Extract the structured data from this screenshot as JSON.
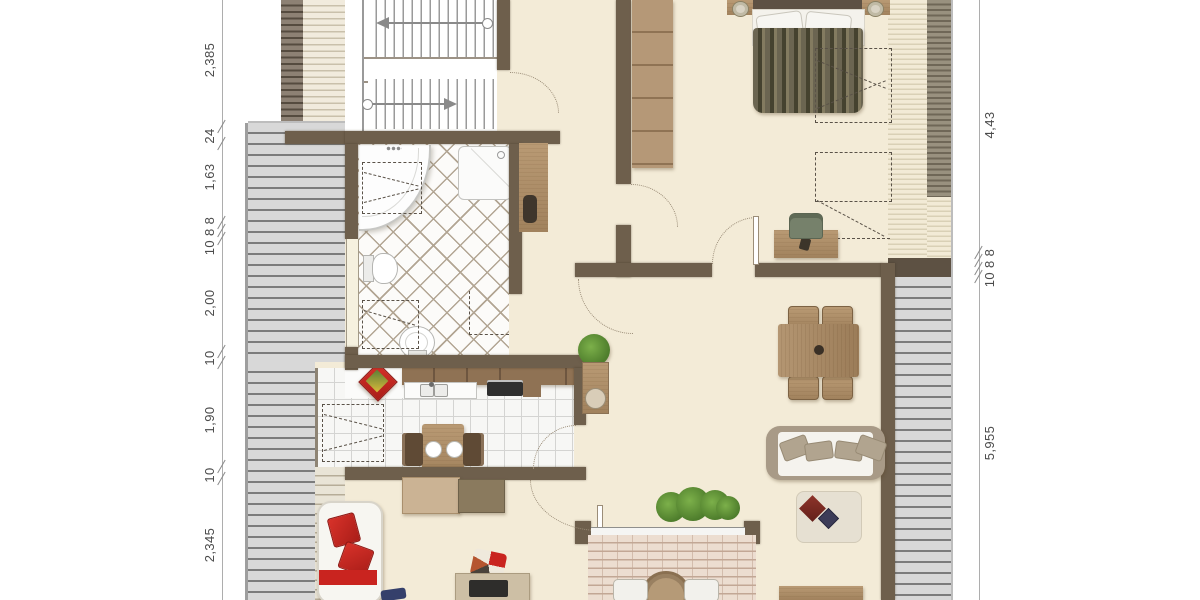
{
  "drawing": {
    "type": "floor-plan",
    "dimensions": {
      "left": [
        {
          "text": "2,385"
        },
        {
          "text": "24"
        },
        {
          "text": "1,63"
        },
        {
          "text": "10 8 8"
        },
        {
          "text": "2,00"
        },
        {
          "text": "10"
        },
        {
          "text": "1,90"
        },
        {
          "text": "10"
        },
        {
          "text": "2,345"
        }
      ],
      "right": [
        {
          "text": "4,43"
        },
        {
          "text": "10 8 8"
        },
        {
          "text": "5,955"
        }
      ]
    },
    "colors": {
      "wall": "#6e5f4c",
      "floor": "#f3ebd7",
      "terrace_stripe": "#d8d8d8",
      "accent_red": "#c9241f",
      "plant_green": "#4e7d2c",
      "wood": "#a98a66"
    },
    "icons": [
      "stair-up-arrow-icon",
      "stair-down-arrow-icon",
      "door-swing-arc-icon",
      "roof-slope-dashes-icon"
    ]
  }
}
